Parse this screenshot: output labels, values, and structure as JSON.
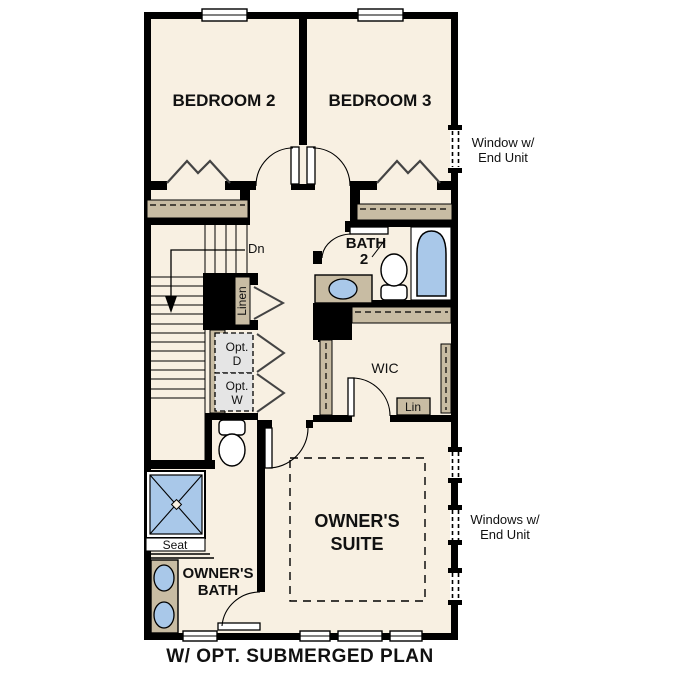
{
  "title": "W/ OPT. SUBMERGED PLAN",
  "rooms": {
    "bedroom2": "BEDROOM 2",
    "bedroom3": "BEDROOM 3",
    "bath2": {
      "line1": "BATH",
      "line2": "2"
    },
    "wic": "WIC",
    "owners_suite": {
      "line1": "OWNER'S",
      "line2": "SUITE"
    },
    "owners_bath": {
      "line1": "OWNER'S",
      "line2": "BATH"
    }
  },
  "stairs": {
    "down": "Dn"
  },
  "closets": {
    "linen": "Linen",
    "lin_shelf": "Lin",
    "opt_dryer": {
      "line1": "Opt.",
      "line2": "D"
    },
    "opt_washer": {
      "line1": "Opt.",
      "line2": "W"
    }
  },
  "fixtures": {
    "shower_seat": "Seat"
  },
  "annotations": {
    "bedroom3_window": {
      "line1": "Window w/",
      "line2": "End Unit"
    },
    "owners_suite_windows": {
      "line1": "Windows w/",
      "line2": "End Unit"
    }
  },
  "colors": {
    "wall": "#000000",
    "floor": "#f8f0e2",
    "cabinetry_tan": "#c8bca3",
    "fixture_blue": "#a9c8e9",
    "optional_gray": "#e5e5e5"
  }
}
